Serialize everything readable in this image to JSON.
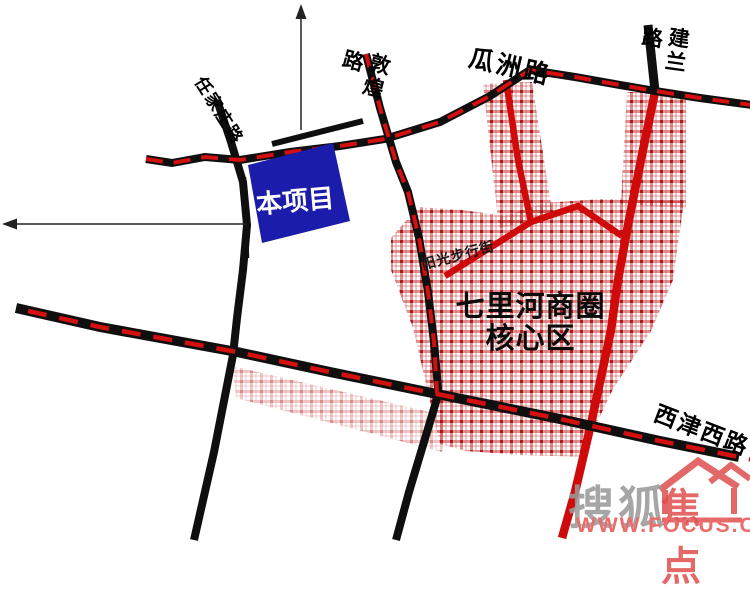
{
  "map": {
    "project": {
      "label": "本项目"
    },
    "district": {
      "line1": "七里河商圈",
      "line2": "核心区"
    },
    "roads": {
      "renjiazhuang": "任家庄路",
      "dunhuang_main": "敦煌",
      "dunhuang_suffix": "路",
      "guazhou": "瓜洲路",
      "jianlan_main": "建兰",
      "jianlan_suffix": "路",
      "yangguang_pedestrian": "阳光步行街",
      "xijinxi": "西津西路"
    },
    "colors": {
      "road_black": "#0f0f0f",
      "centerline_red": "#d40f0f",
      "artery_red": "#cf0a0a",
      "project_blue": "#1c1caa",
      "plaid_red": "#c22222"
    }
  },
  "watermark": {
    "brand_gray": "搜狐",
    "brand_red": "焦点",
    "url": "WWW.FOCUS.CN"
  }
}
